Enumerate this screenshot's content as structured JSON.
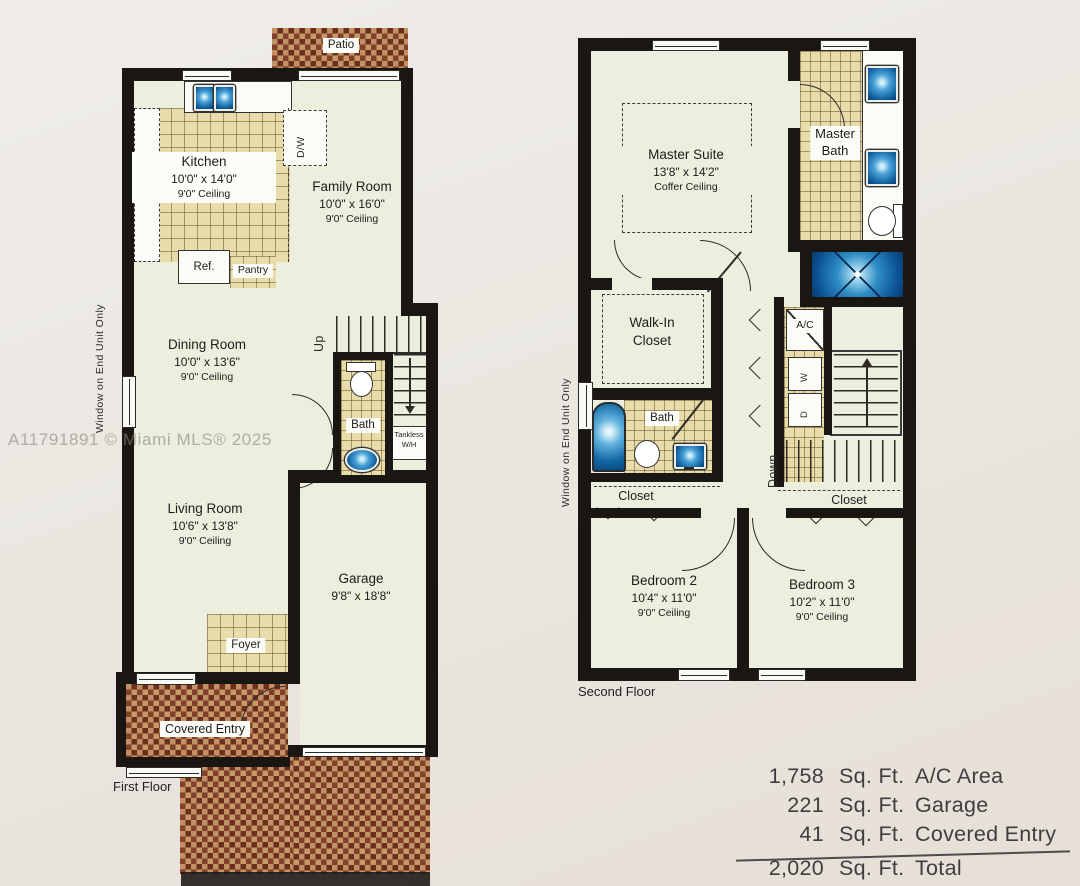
{
  "watermark": "A11791891 © Miami MLS® 2025",
  "first_floor": {
    "caption": "First Floor",
    "window_note": "Window on End Unit Only",
    "patio_label": "Patio",
    "kitchen": {
      "name": "Kitchen",
      "dims": "10'0\" x 14'0\"",
      "ceiling": "9'0\" Ceiling"
    },
    "family_room": {
      "name": "Family Room",
      "dims": "10'0\" x 16'0\"",
      "ceiling": "9'0\" Ceiling"
    },
    "dining_room": {
      "name": "Dining Room",
      "dims": "10'0\" x 13'6\"",
      "ceiling": "9'0\" Ceiling"
    },
    "living_room": {
      "name": "Living Room",
      "dims": "10'6\" x 13'8\"",
      "ceiling": "9'0\" Ceiling"
    },
    "garage": {
      "name": "Garage",
      "dims": "9'8\" x 18'8\""
    },
    "bath_label": "Bath",
    "foyer_label": "Foyer",
    "pantry_label": "Pantry",
    "ref_label": "Ref.",
    "dw_label": "D/W",
    "up_label": "Up",
    "tankless_1": "Tankless",
    "tankless_2": "W/H",
    "covered_entry_label": "Covered Entry"
  },
  "second_floor": {
    "caption": "Second Floor",
    "window_note": "Window on End Unit Only",
    "master_suite": {
      "name": "Master Suite",
      "dims": "13'8\" x 14'2\"",
      "ceiling": "Coffer Ceiling"
    },
    "master_bath_1": "Master",
    "master_bath_2": "Bath",
    "walk_in_1": "Walk-In",
    "walk_in_2": "Closet",
    "bath_label": "Bath",
    "bedroom_2": {
      "name": "Bedroom 2",
      "dims": "10'4\" x 11'0\"",
      "ceiling": "9'0\" Ceiling"
    },
    "bedroom_3": {
      "name": "Bedroom 3",
      "dims": "10'2\" x 11'0\"",
      "ceiling": "9'0\" Ceiling"
    },
    "closet_left_label": "Closet",
    "closet_right_label": "Closet",
    "ac_label": "A/C",
    "washer_label": "W",
    "dryer_label": "D",
    "down_label": "Down"
  },
  "area_table": {
    "rows": [
      {
        "value": "1,758",
        "unit": "Sq. Ft.",
        "label": "A/C Area"
      },
      {
        "value": "221",
        "unit": "Sq. Ft.",
        "label": "Garage"
      },
      {
        "value": "41",
        "unit": "Sq. Ft.",
        "label": "Covered Entry"
      },
      {
        "value": "2,020",
        "unit": "Sq. Ft.",
        "label": "Total"
      }
    ]
  }
}
